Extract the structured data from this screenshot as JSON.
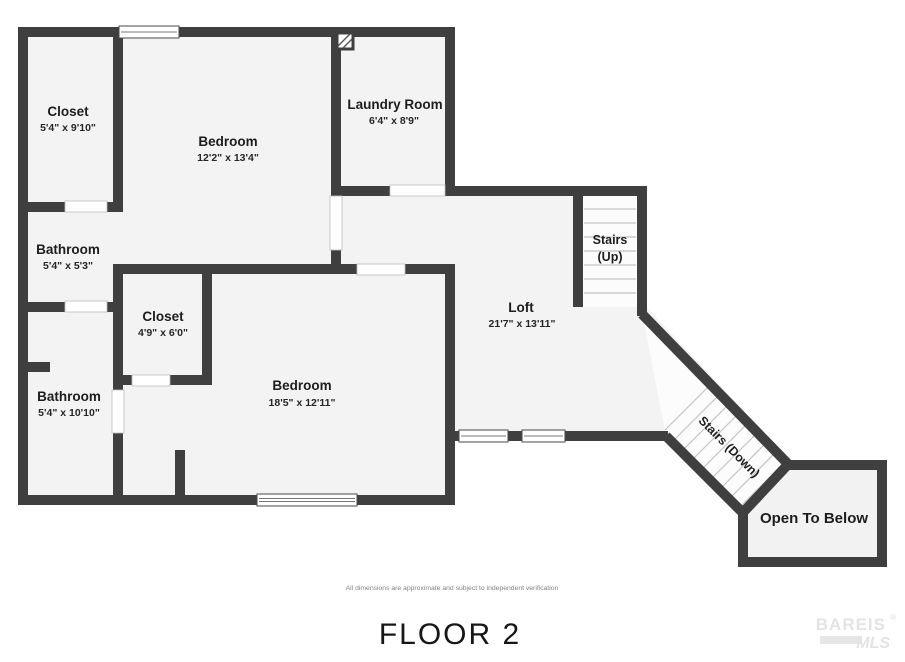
{
  "title": "FLOOR 2",
  "disclaimer": "All dimensions are approximate and subject to independent verification",
  "watermark": {
    "brand": "BAREIS",
    "registered": "®",
    "sub": "MLS"
  },
  "rooms": {
    "closet_upper": {
      "name": "Closet",
      "dims": "5'4\" x 9'10\""
    },
    "bedroom_upper": {
      "name": "Bedroom",
      "dims": "12'2\" x 13'4\""
    },
    "laundry": {
      "name": "Laundry Room",
      "dims": "6'4\" x 8'9\""
    },
    "bathroom_upper": {
      "name": "Bathroom",
      "dims": "5'4\" x 5'3\""
    },
    "closet_lower": {
      "name": "Closet",
      "dims": "4'9\" x 6'0\""
    },
    "bathroom_lower": {
      "name": "Bathroom",
      "dims": "5'4\" x 10'10\""
    },
    "bedroom_lower": {
      "name": "Bedroom",
      "dims": "18'5\" x 12'11\""
    },
    "loft": {
      "name": "Loft",
      "dims": "21'7\" x 13'11\""
    },
    "stairs_up": {
      "line1": "Stairs",
      "line2": "(Up)"
    },
    "stairs_down": {
      "label": "Stairs (Down)"
    },
    "open_to_below": {
      "label": "Open To Below"
    }
  },
  "colors": {
    "wall": "#3f3f3f",
    "floor": "#f3f3f3",
    "background": "#ffffff",
    "stair_tread": "#c3c3c3",
    "label_text": "#1d1d1d",
    "watermark": "#e3e3e3"
  }
}
